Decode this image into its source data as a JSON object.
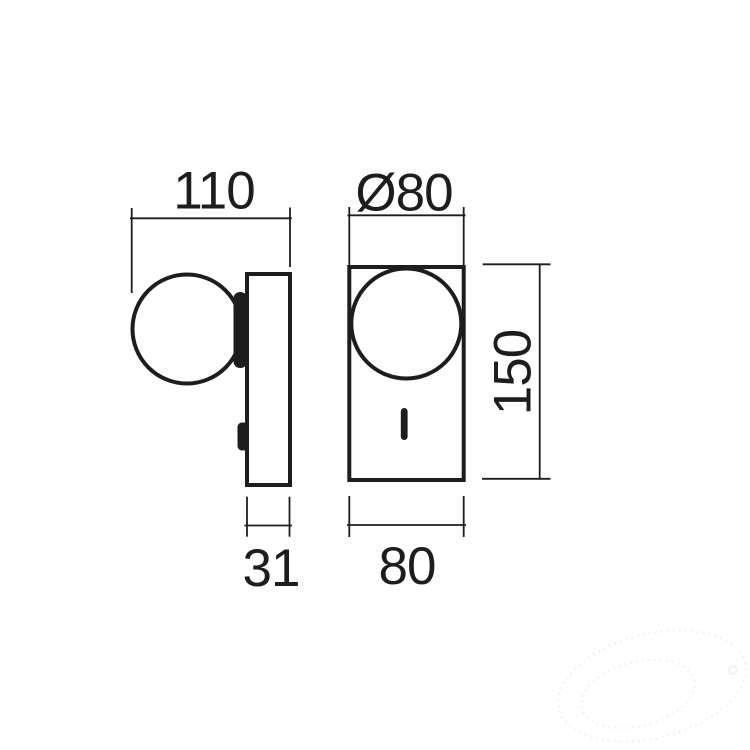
{
  "drawing": {
    "type": "technical-dimension-drawing",
    "subject": "wall-lamp-with-globe-shade-and-switch",
    "views": {
      "side": {
        "name": "side-view"
      },
      "front": {
        "name": "front-view"
      }
    },
    "dimensions": {
      "side_total_width": {
        "label": "110"
      },
      "globe_diameter": {
        "label": "Ø80"
      },
      "body_height": {
        "label": "150"
      },
      "wall_plate_depth": {
        "label": "31"
      },
      "body_width": {
        "label": "80"
      }
    },
    "colors": {
      "line": "#1d1d1b",
      "text": "#1d1d1b",
      "background": "#ffffff",
      "watermark": "#f3f3f3"
    }
  }
}
